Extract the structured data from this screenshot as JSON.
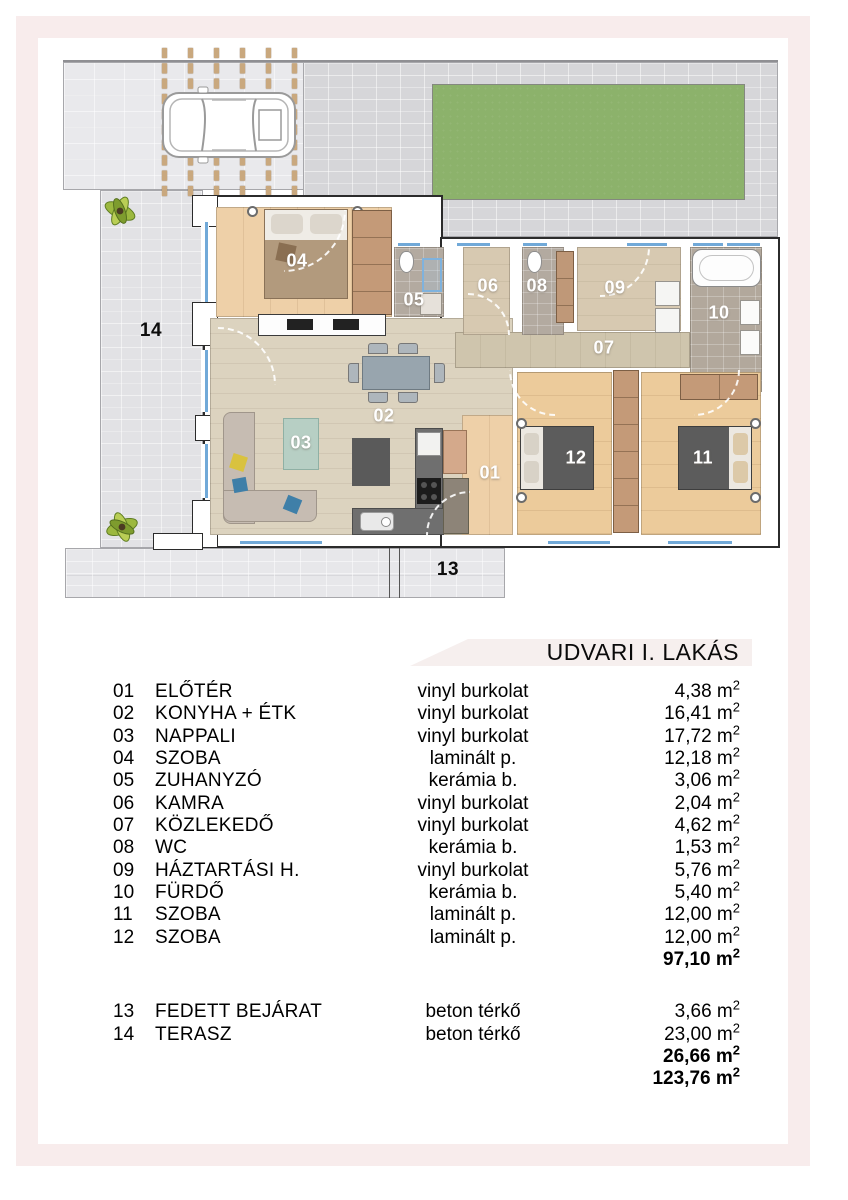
{
  "title": "UDVARI I. LAKÁS",
  "plan": {
    "labels": {
      "r01": "01",
      "r02": "02",
      "r03": "03",
      "r04": "04",
      "r05": "05",
      "r06": "06",
      "r07": "07",
      "r08": "08",
      "r09": "09",
      "r10": "10",
      "r11": "11",
      "r12": "12",
      "r13": "13",
      "r14": "14"
    }
  },
  "table": {
    "interior_rows": [
      {
        "num": "01",
        "name": "ELŐTÉR",
        "material": "vinyl burkolat",
        "area": "4,38 m²"
      },
      {
        "num": "02",
        "name": "KONYHA + ÉTK",
        "material": "vinyl burkolat",
        "area": "16,41 m²"
      },
      {
        "num": "03",
        "name": "NAPPALI",
        "material": "vinyl burkolat",
        "area": "17,72 m²"
      },
      {
        "num": "04",
        "name": "SZOBA",
        "material": "laminált p.",
        "area": "12,18 m²"
      },
      {
        "num": "05",
        "name": "ZUHANYZÓ",
        "material": "kerámia b.",
        "area": "3,06 m²"
      },
      {
        "num": "06",
        "name": "KAMRA",
        "material": "vinyl burkolat",
        "area": "2,04 m²"
      },
      {
        "num": "07",
        "name": "KÖZLEKEDŐ",
        "material": "vinyl burkolat",
        "area": "4,62 m²"
      },
      {
        "num": "08",
        "name": "WC",
        "material": "kerámia b.",
        "area": "1,53 m²"
      },
      {
        "num": "09",
        "name": "HÁZTARTÁSI H.",
        "material": "vinyl burkolat",
        "area": "5,76 m²"
      },
      {
        "num": "10",
        "name": "FÜRDŐ",
        "material": "kerámia b.",
        "area": "5,40 m²"
      },
      {
        "num": "11",
        "name": "SZOBA",
        "material": "laminált p.",
        "area": "12,00 m²"
      },
      {
        "num": "12",
        "name": "SZOBA",
        "material": "laminált p.",
        "area": "12,00 m²"
      }
    ],
    "interior_total": "97,10 m²",
    "outdoor_rows": [
      {
        "num": "13",
        "name": "FEDETT BEJÁRAT",
        "material": "beton térkő",
        "area": "3,66 m²"
      },
      {
        "num": "14",
        "name": "TERASZ",
        "material": "beton térkő",
        "area": "23,00 m²"
      }
    ],
    "outdoor_total": "26,66 m²",
    "grand_total": "123,76 m²"
  },
  "colors": {
    "frame_pink": "#f8ecec",
    "banner_bg": "#f6efee",
    "lawn_green": "#8cb26b",
    "window_blue": "#71a9d8",
    "paving_gray": "#d6d6d9"
  }
}
